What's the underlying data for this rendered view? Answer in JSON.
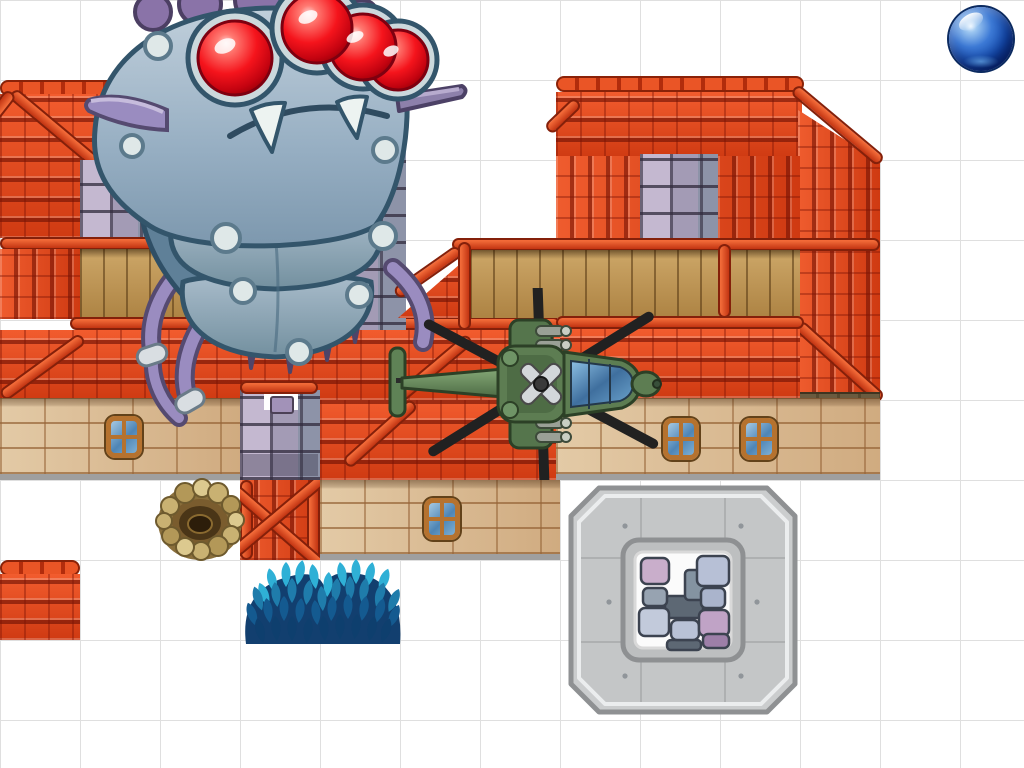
{
  "canvas": {
    "width": 1024,
    "height": 768,
    "grid_cell_px": 80,
    "grid_line_color": "#dfdfdf",
    "background_color": "#ffffff"
  },
  "palette": {
    "roof_shingle_red": "#e2451c",
    "roof_beam_red": "#c23412",
    "roof_beam_outline": "#84200a",
    "wood_plank": "#c49a5c",
    "tan_stone": "#d7b68f",
    "purple_stone": "#a39bb5",
    "platform_gray": "#cbcdce",
    "bush_teal": "#2ea4cd",
    "orb_blue": "#1650b4",
    "monster_body_blue_gray": "#9db4c6",
    "monster_eye_red": "#f5141c",
    "monster_limb_purple": "#9a8cc0",
    "helicopter_green": "#5d7d52",
    "rotor_black": "#212121",
    "window_glass_blue": "#4e85b5",
    "window_frame_orange": "#b5722f"
  },
  "sprites": {
    "monster": {
      "name": "giant bug boss",
      "desc": "large gray-blue segmented caterpillar monster with four glossy red eyes, white fangs, purple horns, tube legs and hanging spikes"
    },
    "helicopter": {
      "name": "attack helicopter",
      "desc": "top-down military helicopter, green fuselage, blue canopy, six black rotor blades, nose pointing right"
    },
    "orb": {
      "name": "blue orb",
      "desc": "glossy blue marble sphere in the top-right corner"
    },
    "platform": {
      "name": "stone octagon platform",
      "desc": "octagonal concrete platform with a square white-framed inset of purple stone bricks"
    },
    "nest": {
      "name": "rock pit nest",
      "desc": "ring of tan boulders around a dark brown burrow"
    },
    "bushes": {
      "name": "blue leaf bushes",
      "desc": "two overlapping teal-blue leafy bushes"
    },
    "buildings": {
      "name": "red-roof houses",
      "desc": "tiled map houses with red shingle roofs, red beams, wooden plank walls, tan stone bases with blue windows, purple stone chimneys"
    }
  },
  "structure_inventory": [
    "left house: hip roof, purple stone window, wood band, shingle apron, tan stone wall with one window",
    "center house: ridge beam, wood band, large shingle apron with cross beams, tan wall with one window, purple chimney tiles, X-braced red tile",
    "right house: ridge cap, gable with diagonal beams, purple stone window, wood band, shingle apron, tan wall with two windows",
    "lone shingle tile bottom-left"
  ]
}
